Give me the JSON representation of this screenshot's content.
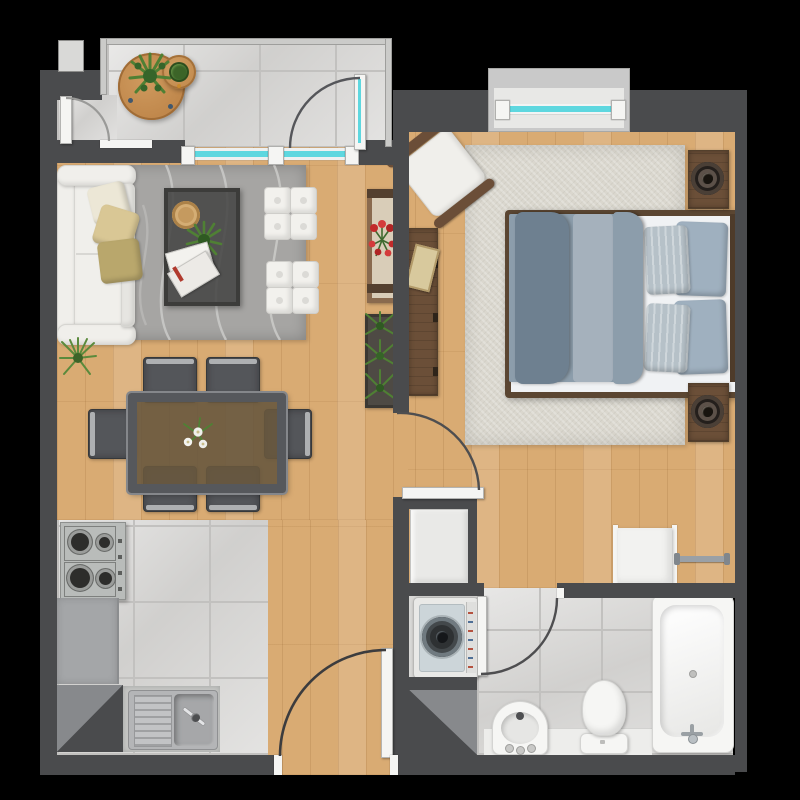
{
  "scene": {
    "kind": "apartment-floor-plan-render",
    "view": "top-down",
    "units": "one-bedroom apartment with balcony"
  },
  "palette": {
    "bg": "#000000",
    "wall": "#4a4b4d",
    "wallLight": "#cbcbc9",
    "wood": "#d9ab73",
    "tile": "#d8d7d5",
    "grout": "#c2c1bf",
    "glass": "#5ed7df",
    "white": "#f5f5f3",
    "sofa": "#f0efeb",
    "rugLiving": "#a6a5a3",
    "rugWave": "#cbcbc9",
    "rugBedroom": "#dad7ce",
    "duvet": "#8c9dab",
    "duvetDark": "#6e8090",
    "duvetLight": "#a5b1bc",
    "mattress": "#f0f2f4",
    "pillow": "#b6c1cc",
    "walnut": "#6b4f38",
    "walnutDark": "#53402c",
    "tableWood": "#c08a4f",
    "chair": "#54565a",
    "chairRail": "#aeb0b2",
    "steel": "#b9bcba",
    "counter": "#a4a6a8",
    "applianceWhite": "#e9e9e7",
    "tubWhite": "#f6f6f4",
    "plantGreen": "#5a8a3c",
    "plantDark": "#3c6428",
    "flowerRed": "#c22a2a"
  },
  "rooms": {
    "balcony": {
      "name": "balcony",
      "floor": "tile",
      "furniture": [
        "round-side-table",
        "potted-plant",
        "round-stool",
        "stool-plant"
      ]
    },
    "living_room": {
      "name": "living-room",
      "floor": "wood",
      "furniture": [
        "sofa",
        "throw-pillow x3",
        "area-rug",
        "coffee-table",
        "serving-tray",
        "potted-plant",
        "magazines",
        "ottoman-set x2",
        "console-table",
        "red-flowers",
        "planter-box",
        "grass-plant"
      ]
    },
    "dining_area": {
      "name": "dining-area",
      "floor": "wood",
      "furniture": [
        "dining-table",
        "dining-chair x6",
        "flower-centerpiece"
      ]
    },
    "kitchen": {
      "name": "kitchen",
      "floor": "tile",
      "furniture": [
        "gas-cooktop",
        "counter",
        "refrigerator-nook",
        "sink-unit"
      ]
    },
    "hallway": {
      "name": "hallway",
      "floor": "wood",
      "furniture": [
        "linen-closet",
        "laundry-nook"
      ]
    },
    "bedroom": {
      "name": "bedroom",
      "floor": "wood",
      "furniture": [
        "double-bed",
        "pillow x4",
        "area-rug",
        "nightstand x2",
        "speaker x2",
        "armchair",
        "sideboard",
        "book",
        "wardrobe-panel",
        "towel-rack"
      ]
    },
    "bathroom": {
      "name": "bathroom",
      "floor": "tile",
      "furniture": [
        "washing-machine",
        "storage-nook",
        "round-basin",
        "toilet",
        "bathtub"
      ]
    }
  },
  "doors": [
    "entry-door",
    "balcony-glass-door",
    "bedroom-door",
    "bathroom-door",
    "entrance-door"
  ],
  "windows": [
    "bedroom-window",
    "living-room-glass-wall"
  ]
}
